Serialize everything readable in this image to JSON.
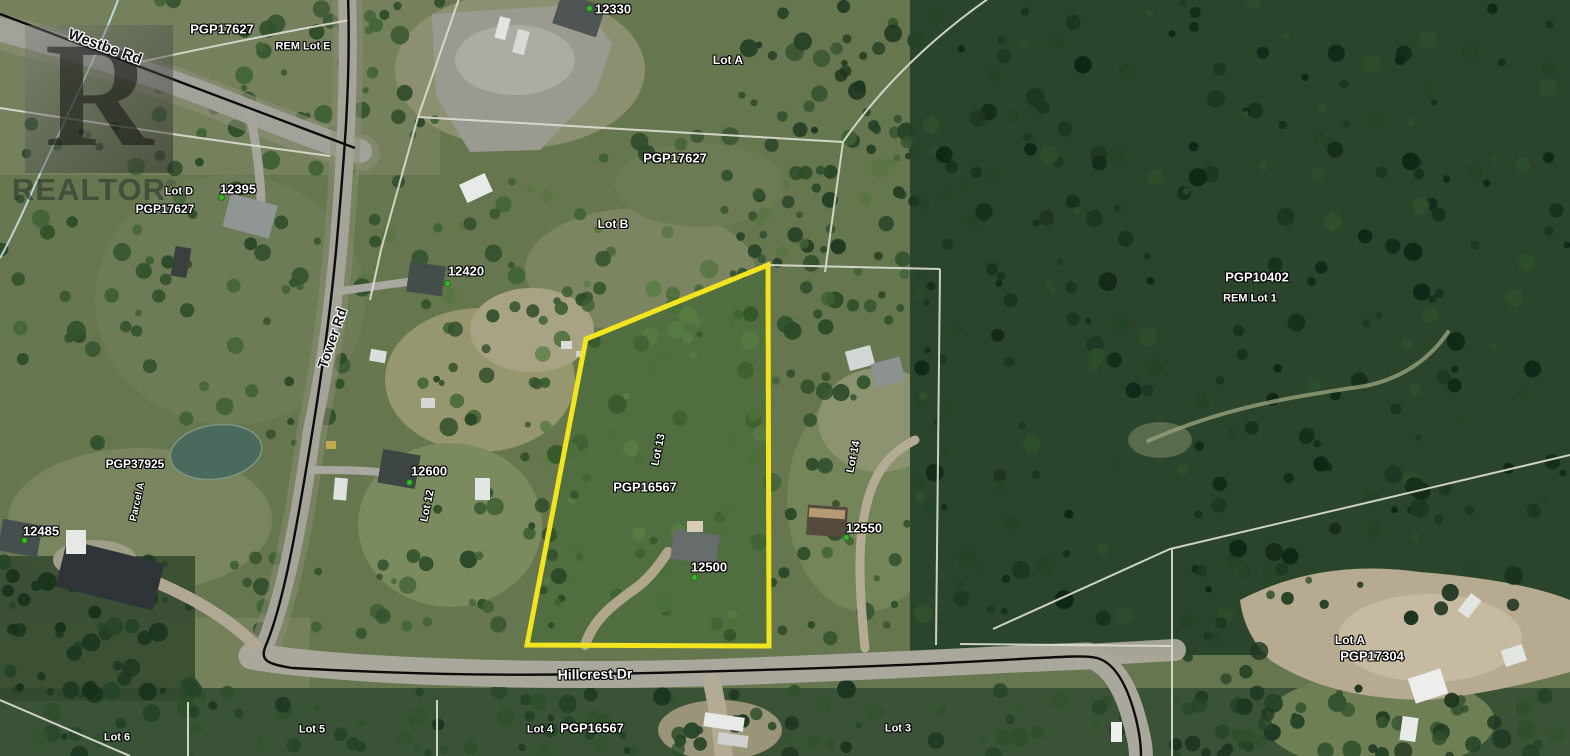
{
  "map": {
    "type": "aerial-parcel-map",
    "watermark": {
      "letter": "R",
      "text": "REALTOR",
      "reg": "®"
    },
    "colors": {
      "parcel_highlight": "#f2e41e",
      "marker_dot": "#3db32d",
      "boundary_white": "#dcdcd2",
      "boundary_black": "#0c0c0c",
      "creek_blue": "#c9e9f2"
    },
    "labels": [
      {
        "text": "Westbe Rd",
        "x": 105,
        "y": 47,
        "rot": 20,
        "style": "road",
        "size": 15
      },
      {
        "text": "PGP17627",
        "x": 222,
        "y": 29,
        "rot": 0,
        "style": "white",
        "size": 13
      },
      {
        "text": "REM Lot E",
        "x": 303,
        "y": 47,
        "rot": 0,
        "style": "white",
        "size": 11
      },
      {
        "text": "12330",
        "x": 613,
        "y": 9,
        "rot": 0,
        "style": "white",
        "size": 13,
        "dot": [
          589,
          8
        ]
      },
      {
        "text": "Lot A",
        "x": 728,
        "y": 60,
        "rot": 0,
        "style": "white",
        "size": 12
      },
      {
        "text": "PGP17627",
        "x": 675,
        "y": 158,
        "rot": 0,
        "style": "white",
        "size": 13
      },
      {
        "text": "Lot B",
        "x": 613,
        "y": 224,
        "rot": 0,
        "style": "white",
        "size": 12
      },
      {
        "text": "Lot D",
        "x": 179,
        "y": 192,
        "rot": 0,
        "style": "white",
        "size": 11
      },
      {
        "text": "PGP17627",
        "x": 165,
        "y": 209,
        "rot": 0,
        "style": "white",
        "size": 12
      },
      {
        "text": "12395",
        "x": 238,
        "y": 189,
        "rot": 0,
        "style": "white",
        "size": 13,
        "dot": [
          221,
          197
        ]
      },
      {
        "text": "12420",
        "x": 466,
        "y": 271,
        "rot": 0,
        "style": "white",
        "size": 13,
        "dot": [
          447,
          283
        ]
      },
      {
        "text": "Tower Rd",
        "x": 332,
        "y": 338,
        "rot": -71,
        "style": "road",
        "size": 14
      },
      {
        "text": "PGP10402",
        "x": 1257,
        "y": 277,
        "rot": 0,
        "style": "white",
        "size": 13
      },
      {
        "text": "REM Lot 1",
        "x": 1250,
        "y": 299,
        "rot": 0,
        "style": "white",
        "size": 11
      },
      {
        "text": "12600",
        "x": 429,
        "y": 471,
        "rot": 0,
        "style": "white",
        "size": 13,
        "dot": [
          409,
          482
        ]
      },
      {
        "text": "Lot 12",
        "x": 428,
        "y": 506,
        "rot": -78,
        "style": "white",
        "size": 11
      },
      {
        "text": "PGP37925",
        "x": 135,
        "y": 464,
        "rot": 0,
        "style": "white",
        "size": 12
      },
      {
        "text": "Parcel A",
        "x": 138,
        "y": 502,
        "rot": -78,
        "style": "white",
        "size": 10
      },
      {
        "text": "12485",
        "x": 41,
        "y": 531,
        "rot": 0,
        "style": "white",
        "size": 13,
        "dot": [
          24,
          540
        ]
      },
      {
        "text": "Lot 13",
        "x": 659,
        "y": 450,
        "rot": -78,
        "style": "white",
        "size": 11
      },
      {
        "text": "PGP16567",
        "x": 645,
        "y": 487,
        "rot": 0,
        "style": "white",
        "size": 13
      },
      {
        "text": "12500",
        "x": 709,
        "y": 567,
        "rot": 0,
        "style": "white",
        "size": 13,
        "dot": [
          694,
          577
        ]
      },
      {
        "text": "Lot 14",
        "x": 854,
        "y": 457,
        "rot": -78,
        "style": "white",
        "size": 11
      },
      {
        "text": "12550",
        "x": 864,
        "y": 528,
        "rot": 0,
        "style": "white",
        "size": 13,
        "dot": [
          846,
          537
        ]
      },
      {
        "text": "Hillcrest Dr",
        "x": 595,
        "y": 674,
        "rot": -1,
        "style": "white",
        "size": 14
      },
      {
        "text": "Lot A",
        "x": 1350,
        "y": 640,
        "rot": 0,
        "style": "white",
        "size": 12
      },
      {
        "text": "PGP17304",
        "x": 1372,
        "y": 656,
        "rot": 0,
        "style": "white",
        "size": 13
      },
      {
        "text": "Lot 6",
        "x": 117,
        "y": 738,
        "rot": 0,
        "style": "white",
        "size": 11
      },
      {
        "text": "Lot 5",
        "x": 312,
        "y": 730,
        "rot": 0,
        "style": "white",
        "size": 11
      },
      {
        "text": "Lot 4",
        "x": 540,
        "y": 730,
        "rot": 0,
        "style": "white",
        "size": 11
      },
      {
        "text": "PGP16567",
        "x": 592,
        "y": 728,
        "rot": 0,
        "style": "white",
        "size": 13
      },
      {
        "text": "Lot 3",
        "x": 898,
        "y": 729,
        "rot": 0,
        "style": "white",
        "size": 11
      }
    ]
  }
}
